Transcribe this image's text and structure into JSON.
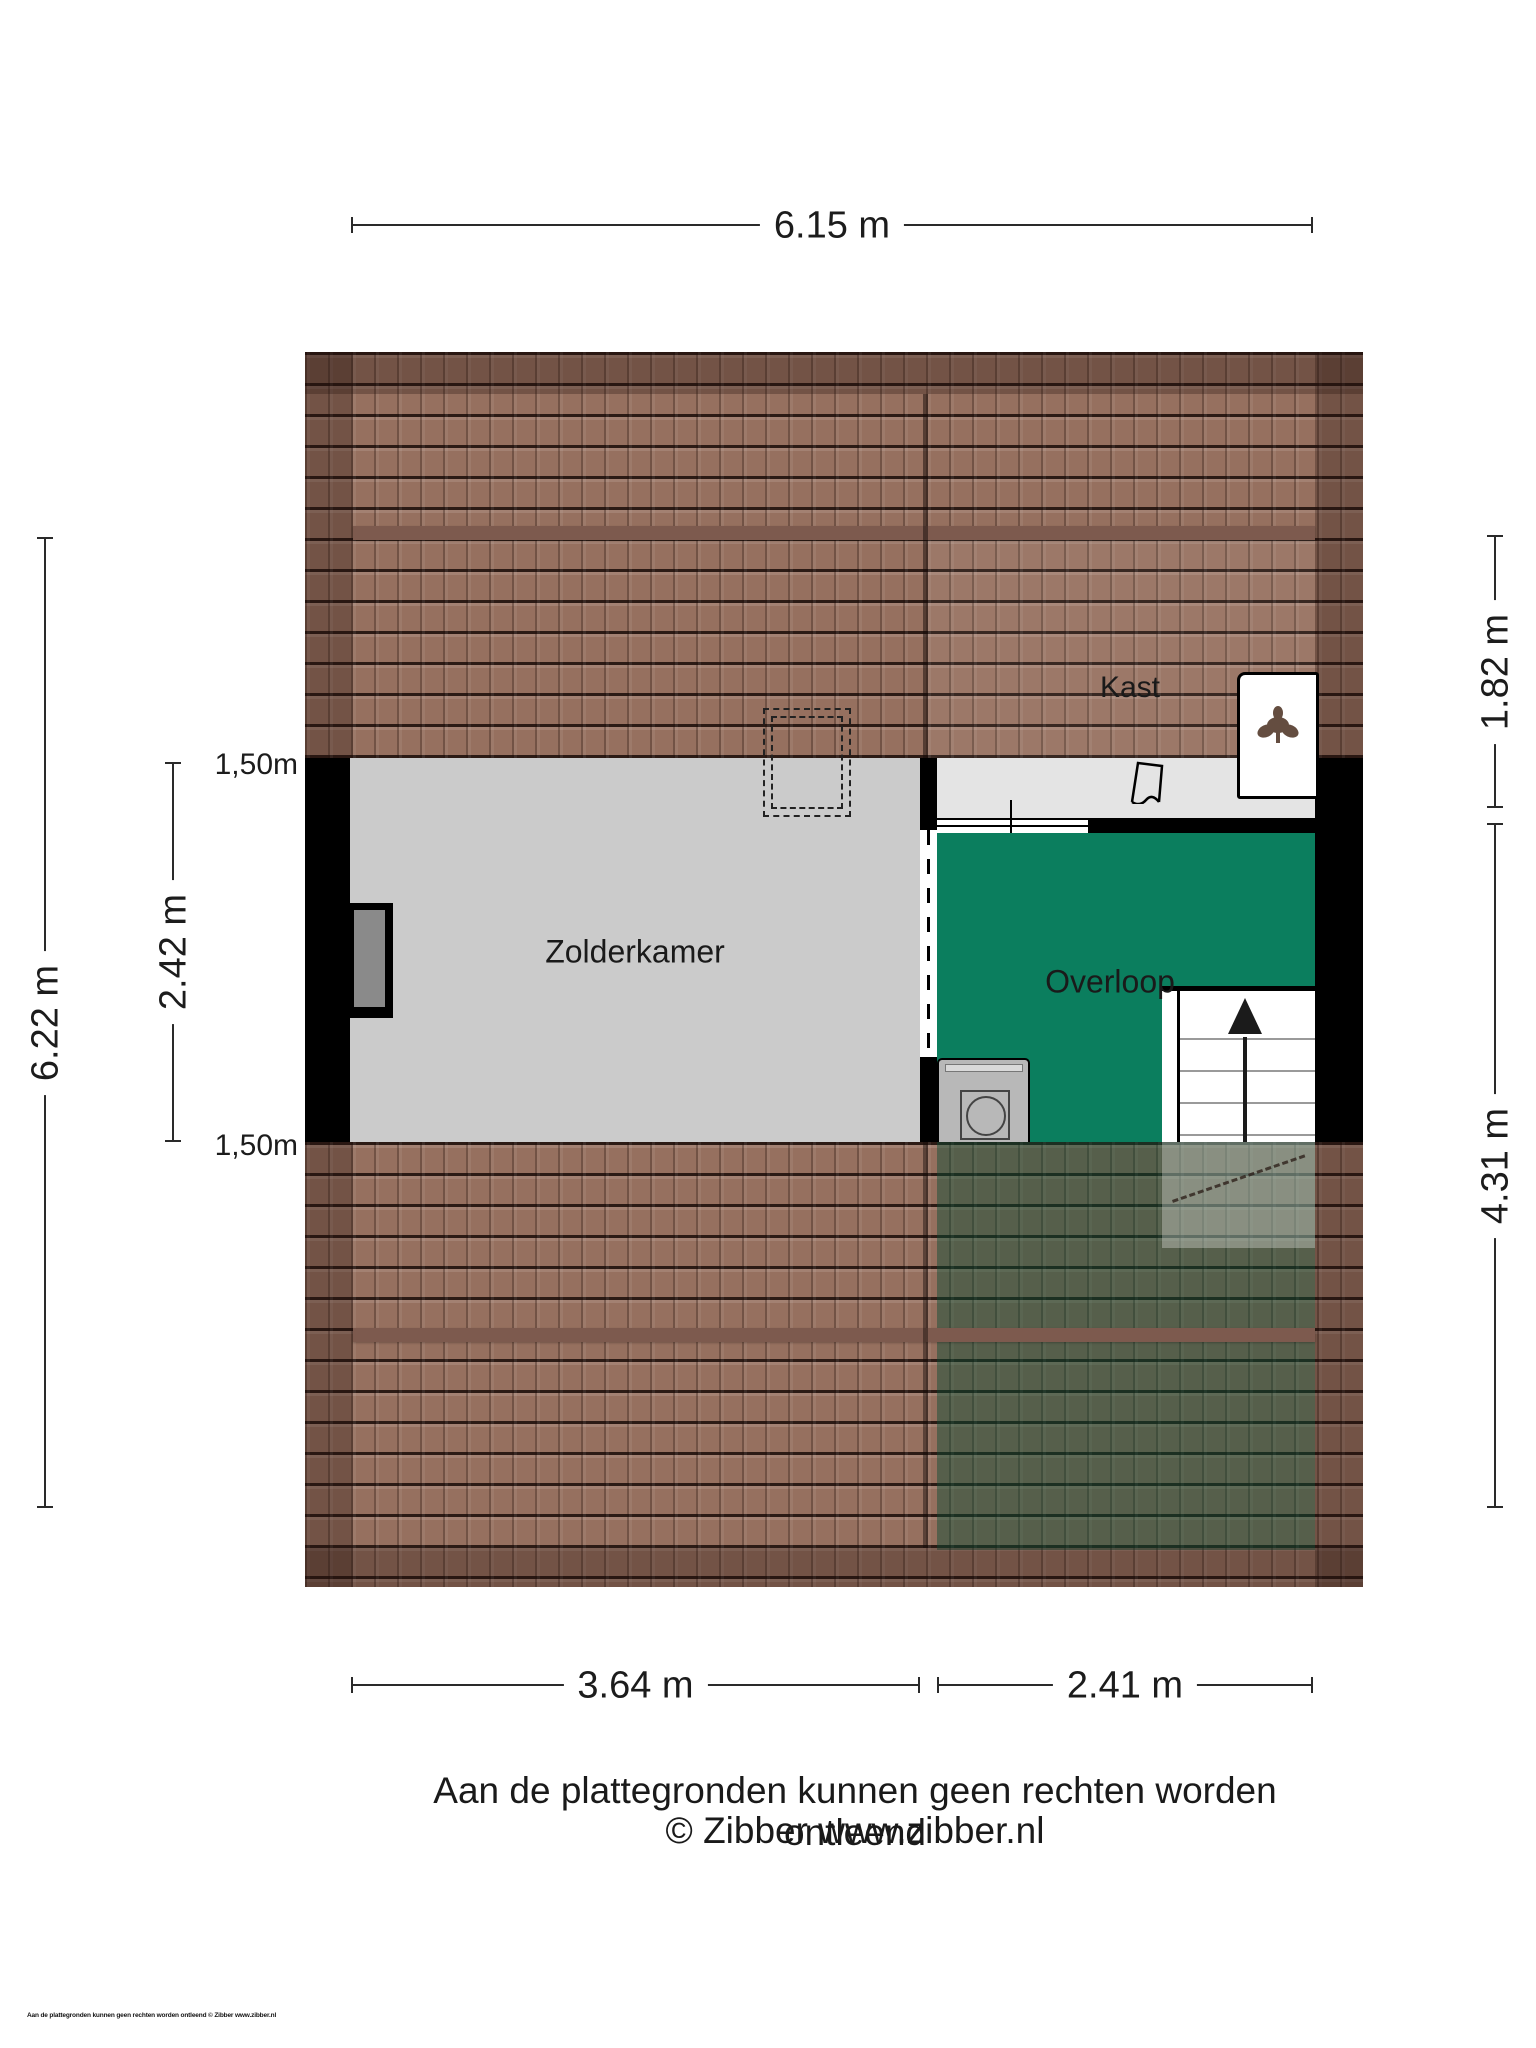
{
  "plan_title": "Attic floor plan (Zibber)",
  "rooms": {
    "zolderkamer": "Zolderkamer",
    "overloop": "Overloop",
    "kast": "Kast"
  },
  "dimensions": {
    "top": "6.15 m",
    "left_outer": "6.22 m",
    "left_inner": "2.42 m",
    "left_marker_top": "1,50m",
    "left_marker_bottom": "1,50m",
    "right_top": "1.82 m",
    "right_bottom": "4.31 m",
    "bottom_left": "3.64 m",
    "bottom_right": "2.41 m"
  },
  "footer": {
    "disclaimer": "Aan de plattegronden kunnen geen rechten worden ontleend",
    "credit": "© Zibber www.zibber.nl",
    "micro": "Aan de plattegronden kunnen geen rechten worden ontleend © Zibber www.zibber.nl"
  },
  "icons": {
    "stairs_arrow": "arrow-up",
    "washing_machine": "washing-machine",
    "plant": "plant",
    "door_swing": "door-swing"
  },
  "colors": {
    "roof_tile": "#96705f",
    "roof_dark_edge": "rgba(35,18,12,0.30)",
    "roof_ridge": "#7d5a4e",
    "floor_zolder": "#cbcbcb",
    "floor_kast": "#e4e4e4",
    "overloop_green": "#0b7e5e",
    "wall_black": "#000000",
    "shaft_gray": "#7f7f7f",
    "window_glass": "#8a8a8a",
    "washer_gray": "#b8b8b8",
    "dim_line": "#2a2a2a",
    "text": "#1c1c1c"
  }
}
